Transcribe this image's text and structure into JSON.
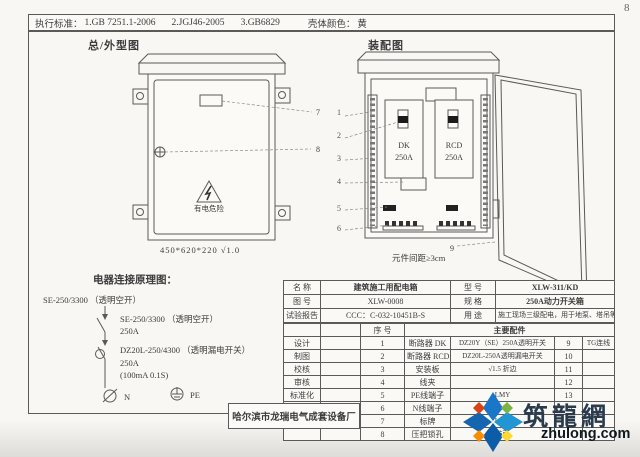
{
  "page": {
    "number": "8"
  },
  "header": {
    "standards_label": "执行标准：",
    "standards": [
      "1.GB 7251.1-2006",
      "2.JGJ46-2005",
      "3.GB6829"
    ],
    "color_label": "壳体颜色：",
    "color_value": "黄"
  },
  "outline_drawing": {
    "title": "总/外型图",
    "danger_label": "有电危险",
    "dimensions": "450*620*220  √1.0",
    "callouts": [
      "7",
      "8"
    ]
  },
  "assembly_drawing": {
    "title": "装配图",
    "breaker_left": {
      "name": "DK",
      "rating": "250A"
    },
    "breaker_right": {
      "name": "RCD",
      "rating": "250A"
    },
    "spacing_note": "元件间距≥3cm",
    "callouts": [
      "1",
      "2",
      "3",
      "4",
      "5",
      "6",
      "9"
    ]
  },
  "schematic": {
    "title": "电器连接原理图：",
    "incoming": "SE-250/3300 （透明空开）",
    "breaker1_model": "SE-250/3300 （透明空开）",
    "breaker1_rating": "250A",
    "breaker2_model": "DZ20L-250/4300 （透明漏电开关）",
    "breaker2_rating": "250A",
    "breaker2_param": "(100mA 0.1S)",
    "n_label": "N",
    "pe_label": "PE"
  },
  "title_block": {
    "name_label": "名 称",
    "name_value": "建筑施工用配电箱",
    "model_label": "型 号",
    "model_value": "XLW-311/KD",
    "drawing_no_label": "图 号",
    "drawing_no_value": "XLW-0008",
    "spec_label": "规 格",
    "spec_value": "250A动力开关箱",
    "report_label": "试验报告",
    "report_value": "CCC：C-032-10451B-S",
    "use_label": "用 途",
    "use_value": "施工现场三级配电，用于地泵、塔吊等",
    "seq_label": "序 号",
    "parts_label": "主要配件",
    "rows": [
      {
        "role": "设计",
        "no": "1",
        "part": "断路器 DK",
        "spec": "DZ20Y（SE）250A透明开关",
        "no2": "9",
        "note": "TG连线"
      },
      {
        "role": "制图",
        "no": "2",
        "part": "断路器 RCD",
        "spec": "DZ20L-250A透明漏电开关",
        "no2": "10",
        "note": ""
      },
      {
        "role": "校核",
        "no": "3",
        "part": "安装板",
        "spec": "√1.5 折边",
        "no2": "11",
        "note": ""
      },
      {
        "role": "审核",
        "no": "4",
        "part": "线夹",
        "spec": "",
        "no2": "12",
        "note": ""
      },
      {
        "role": "标准化",
        "no": "5",
        "part": "PE线端子",
        "spec": "LMY",
        "no2": "13",
        "note": ""
      },
      {
        "role": "日期",
        "no": "6",
        "part": "N线端子",
        "spec": "LMY",
        "no2": "14",
        "note": ""
      },
      {
        "role": "",
        "no": "7",
        "part": "标牌",
        "spec": "LMY",
        "no2": "",
        "note": ""
      },
      {
        "role": "",
        "no": "8",
        "part": "压把锁孔",
        "spec": "防雨",
        "no2": "",
        "note": ""
      }
    ]
  },
  "manufacturer": "哈尔滨市龙瑞电气成套设备厂",
  "watermark": {
    "name": "筑龍網",
    "domain": "zhulong.com"
  },
  "colors": {
    "paper": "#f8f7f4",
    "line": "#5a5a5a",
    "logo_blue_1": "#1976c8",
    "logo_blue_2": "#0d5ca8",
    "logo_green": "#7cb342",
    "logo_yellow": "#fdd835",
    "logo_orange": "#fb8c00",
    "logo_red": "#d84315",
    "wm_text": "#2b3b4e"
  }
}
